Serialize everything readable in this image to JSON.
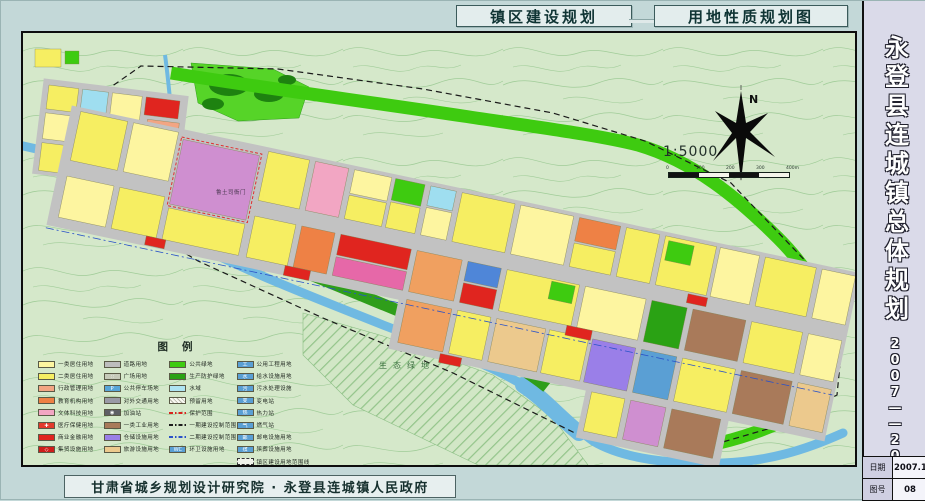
{
  "titles": {
    "left": "镇区建设规划",
    "right": "用地性质规划图"
  },
  "sidebar": {
    "title": "永登县连城镇总体规划",
    "period": "2007——2020",
    "info": {
      "date_label": "日期",
      "date_value": "2007.11",
      "sheet_label": "图号",
      "sheet_value": "08"
    }
  },
  "credit": "甘肃省城乡规划设计研究院 · 永登县连城镇人民政府",
  "map": {
    "north_label": "N",
    "scale_text": "1:5000",
    "scalebar_ticks": [
      "0",
      "100",
      "200",
      "300",
      "400m"
    ],
    "labels": {
      "heritage": "鲁土司衙门",
      "eco": "生态绿地"
    }
  },
  "legend": {
    "title": "图例",
    "columns": [
      [
        {
          "label": "一类居住用地",
          "type": "fill",
          "fill": "#fdf5a0"
        },
        {
          "label": "二类居住用地",
          "type": "fill",
          "fill": "#f6ee62"
        },
        {
          "label": "行政管理用地",
          "type": "fill",
          "fill": "#f2a583"
        },
        {
          "label": "教育机构用地",
          "type": "fill",
          "fill": "#ee8145"
        },
        {
          "label": "文体科技用地",
          "type": "fill",
          "fill": "#f2a6c3"
        },
        {
          "label": "医疗保健用地",
          "type": "fill",
          "fill": "#e23a2c",
          "glyph": "✚"
        },
        {
          "label": "商业金融用地",
          "type": "fill",
          "fill": "#e02520"
        },
        {
          "label": "集贸设施用地",
          "type": "fill",
          "fill": "#cf1d1a",
          "glyph": "◇"
        }
      ],
      [
        {
          "label": "道路用地",
          "type": "fill",
          "fill": "#bdbdbd"
        },
        {
          "label": "广场用地",
          "type": "fill",
          "fill": "#c6cab9",
          "glyph": "∷"
        },
        {
          "label": "公共停车场地",
          "type": "fill",
          "fill": "#58a6d8",
          "glyph": "P"
        },
        {
          "label": "对外交通用地",
          "type": "fill",
          "fill": "#9a9aa6"
        },
        {
          "label": "加油站",
          "type": "fill",
          "fill": "#5f5f66",
          "glyph": "◉"
        },
        {
          "label": "一类工业用地",
          "type": "fill",
          "fill": "#a97a5a"
        },
        {
          "label": "仓储设施用地",
          "type": "fill",
          "fill": "#9a7fe8"
        },
        {
          "label": "旅游设施用地",
          "type": "fill",
          "fill": "#ecc98d"
        }
      ],
      [
        {
          "label": "公共绿地",
          "type": "fill",
          "fill": "#3ecb10"
        },
        {
          "label": "生产防护绿地",
          "type": "fill",
          "fill": "#2aa214"
        },
        {
          "label": "水域",
          "type": "fill",
          "fill": "#aee4f2"
        },
        {
          "label": "预留用地",
          "type": "hatch"
        },
        {
          "label": "保护范围",
          "type": "line-red"
        },
        {
          "label": "一期建设控制范围",
          "type": "line-black"
        },
        {
          "label": "二期建设控制范围",
          "type": "line-blue"
        },
        {
          "label": "环卫设施用地",
          "type": "fill",
          "fill": "#5a9fd4",
          "glyph": "WC"
        }
      ],
      [
        {
          "label": "公用工程用地",
          "type": "fill",
          "fill": "#5a9fd4",
          "glyph": "工"
        },
        {
          "label": "给水设施用地",
          "type": "fill",
          "fill": "#5a9fd4",
          "glyph": "水"
        },
        {
          "label": "污水处理设施",
          "type": "fill",
          "fill": "#5a9fd4",
          "glyph": "污"
        },
        {
          "label": "变电站",
          "type": "fill",
          "fill": "#5a9fd4",
          "glyph": "变"
        },
        {
          "label": "热力站",
          "type": "fill",
          "fill": "#5a9fd4",
          "glyph": "热"
        },
        {
          "label": "燃气站",
          "type": "fill",
          "fill": "#5a9fd4",
          "glyph": "气"
        },
        {
          "label": "邮电设施用地",
          "type": "fill",
          "fill": "#5a9fd4",
          "glyph": "邮"
        },
        {
          "label": "殡葬设施用地",
          "type": "fill",
          "fill": "#5a9fd4",
          "glyph": "殡"
        },
        {
          "label": "镇区建设用地范围线",
          "type": "dashbox"
        }
      ]
    ]
  }
}
